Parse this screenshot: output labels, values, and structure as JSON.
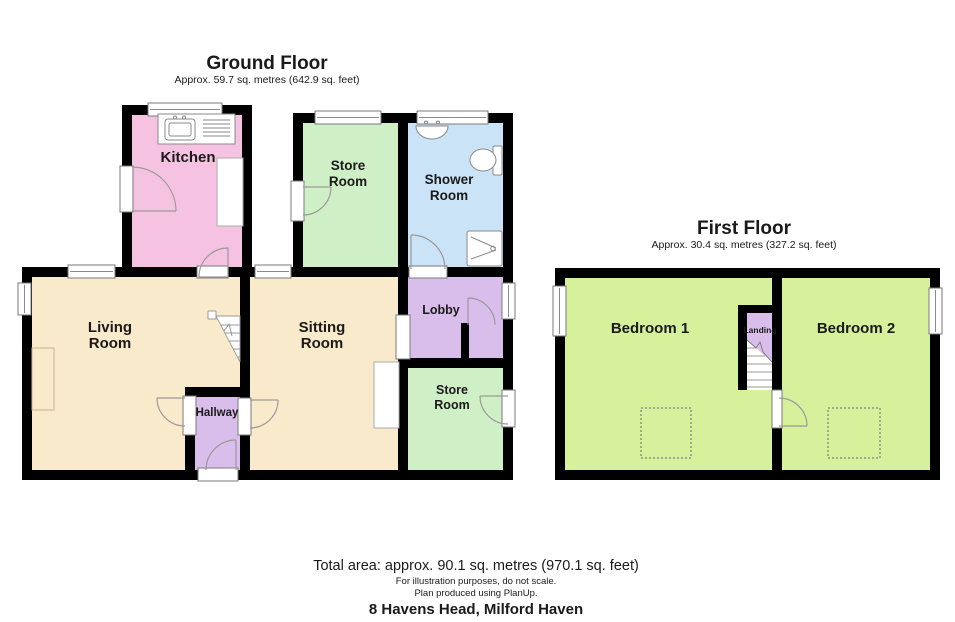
{
  "colors": {
    "wall": "#000000",
    "kitchen_pink": "#F5C3E1",
    "store_green": "#CFEFC6",
    "shower_blue": "#CBE3F6",
    "cream": "#FAEACC",
    "purple": "#D9BDEB",
    "bedroom_green": "#D6F09C"
  },
  "ground_floor": {
    "title": "Ground Floor",
    "subtitle": "Approx. 59.7 sq. metres (642.9 sq. feet)",
    "rooms": {
      "kitchen": "Kitchen",
      "store_room_1": [
        "Store",
        "Room"
      ],
      "shower_room": [
        "Shower",
        "Room"
      ],
      "living_room": [
        "Living",
        "Room"
      ],
      "sitting_room": [
        "Sitting",
        "Room"
      ],
      "lobby": "Lobby",
      "store_room_2": [
        "Store",
        "Room"
      ],
      "hallway": "Hallway"
    }
  },
  "first_floor": {
    "title": "First Floor",
    "subtitle": "Approx. 30.4 sq. metres (327.2 sq. feet)",
    "rooms": {
      "bedroom_1": "Bedroom 1",
      "bedroom_2": "Bedroom 2",
      "landing": "Landing"
    }
  },
  "footer": {
    "total_area": "Total area: approx. 90.1 sq. metres (970.1 sq. feet)",
    "disclaimer_line1": "For illustration purposes, do not scale.",
    "disclaimer_line2": "Plan produced using PlanUp.",
    "address": "8 Havens Head, Milford Haven"
  }
}
